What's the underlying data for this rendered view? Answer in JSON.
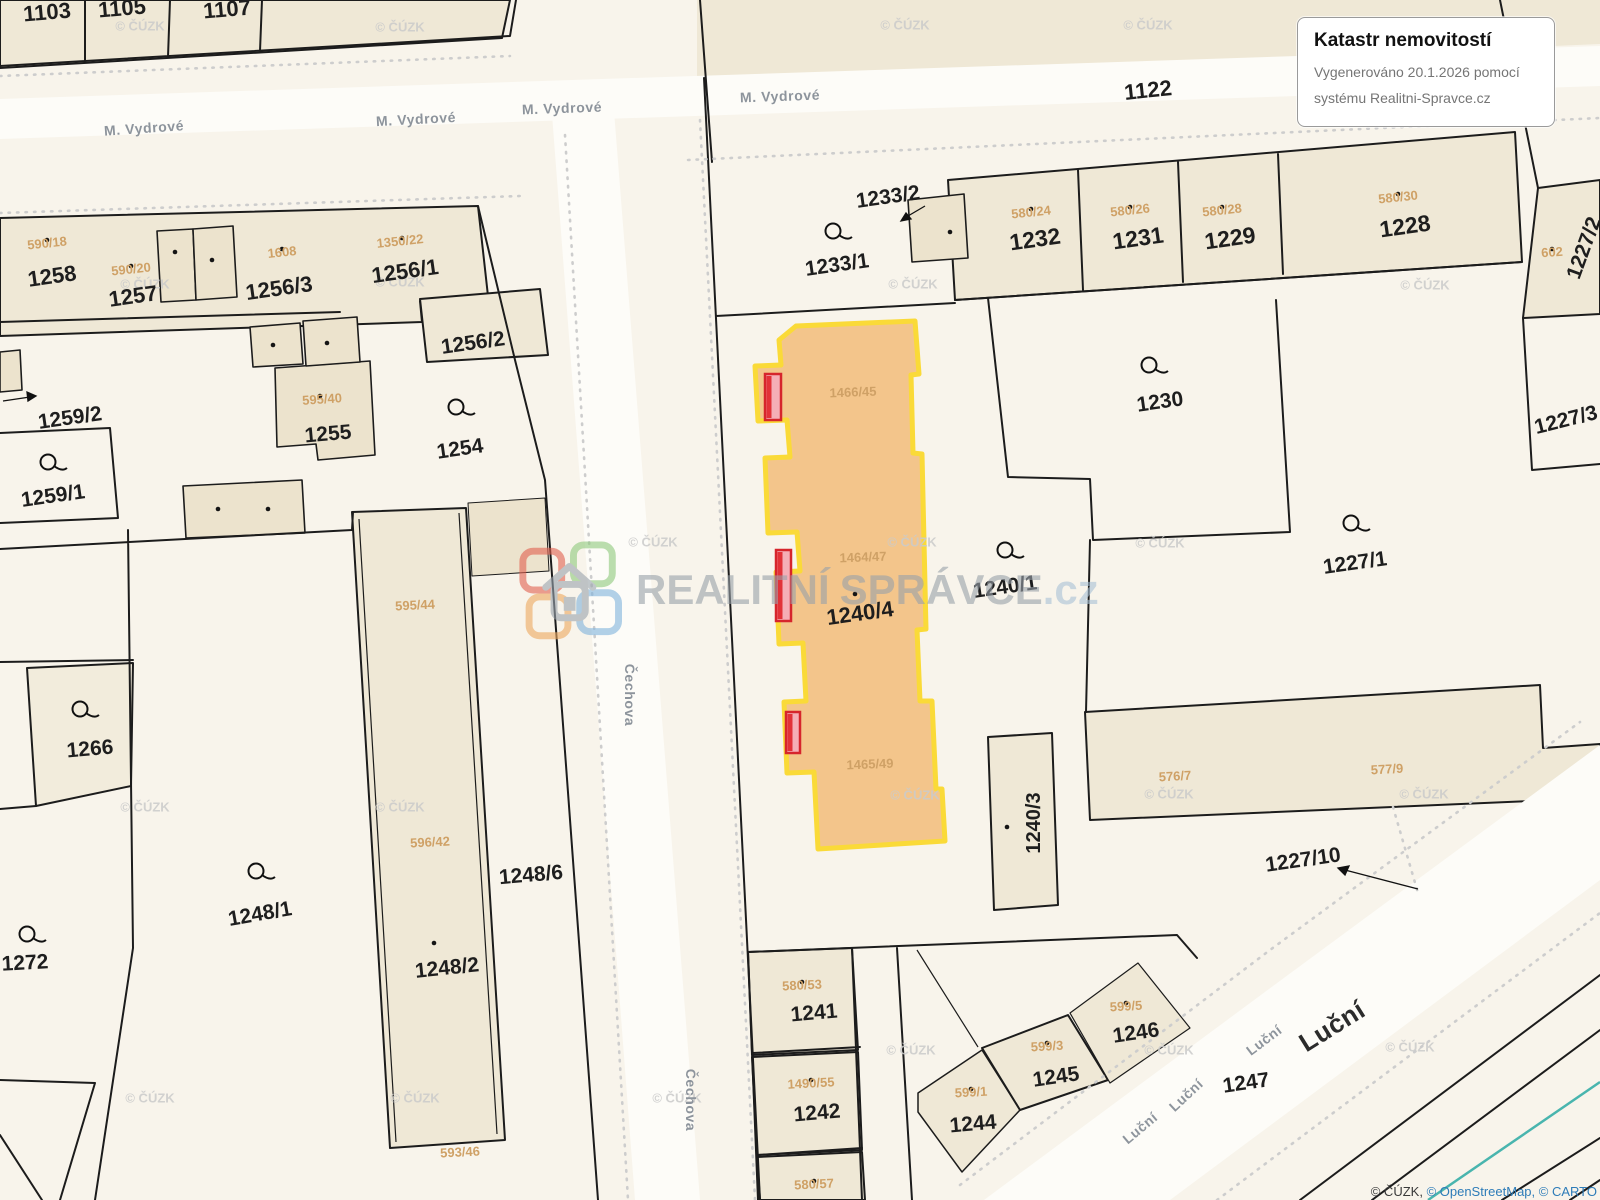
{
  "info_box": {
    "title": "Katastr nemovitostí",
    "line1": "Vygenerováno 20.1.2026 pomocí",
    "line2": "systému Realitni-Spravce.cz"
  },
  "watermark_brand": {
    "part1": "REALITNÍ",
    "part2": "SPRÁVCE",
    "part3": ".cz"
  },
  "attribution": {
    "cuzk": "© ČÚZK,",
    "osm": "© OpenStreetMap,",
    "carto": "© CARTO"
  },
  "map": {
    "highlighted_parcel": "1240/4",
    "colors": {
      "highlight_fill": "#f2c183",
      "highlight_border": "#fada38",
      "marker": "#d6252c"
    },
    "cuzk_watermark_text": "© ČÚZK",
    "parcel_labels": [
      {
        "t": "1103",
        "x": 47,
        "y": 12,
        "r": -5,
        "s": 22
      },
      {
        "t": "1105",
        "x": 122,
        "y": 8,
        "r": -5,
        "s": 22
      },
      {
        "t": "1107",
        "x": 227,
        "y": 9,
        "r": -5,
        "s": 22
      },
      {
        "t": "1122",
        "x": 1148,
        "y": 90,
        "r": -6,
        "s": 22
      },
      {
        "t": "1258",
        "x": 52,
        "y": 276,
        "r": -8,
        "s": 22
      },
      {
        "t": "1257",
        "x": 133,
        "y": 296,
        "r": -8,
        "s": 22
      },
      {
        "t": "1256/3",
        "x": 279,
        "y": 288,
        "r": -8,
        "s": 22
      },
      {
        "t": "1256/1",
        "x": 405,
        "y": 271,
        "r": -8,
        "s": 22
      },
      {
        "t": "1256/2",
        "x": 473,
        "y": 343,
        "r": -8,
        "s": 21
      },
      {
        "t": "1255",
        "x": 328,
        "y": 434,
        "r": -5,
        "s": 21
      },
      {
        "t": "1254",
        "x": 460,
        "y": 449,
        "r": -8,
        "s": 21
      },
      {
        "t": "1259/2",
        "x": 70,
        "y": 418,
        "r": -8,
        "s": 21
      },
      {
        "t": "1259/1",
        "x": 53,
        "y": 496,
        "r": -8,
        "s": 21
      },
      {
        "t": "1266",
        "x": 90,
        "y": 749,
        "r": -5,
        "s": 21
      },
      {
        "t": "1272",
        "x": 25,
        "y": 963,
        "r": -3,
        "s": 21
      },
      {
        "t": "1248/1",
        "x": 260,
        "y": 914,
        "r": -10,
        "s": 21
      },
      {
        "t": "1248/2",
        "x": 447,
        "y": 968,
        "r": -6,
        "s": 21
      },
      {
        "t": "1248/6",
        "x": 531,
        "y": 875,
        "r": -5,
        "s": 21
      },
      {
        "t": "1233/2",
        "x": 888,
        "y": 197,
        "r": -8,
        "s": 21
      },
      {
        "t": "1233/1",
        "x": 837,
        "y": 265,
        "r": -8,
        "s": 21
      },
      {
        "t": "1232",
        "x": 1035,
        "y": 239,
        "r": -8,
        "s": 23
      },
      {
        "t": "1231",
        "x": 1138,
        "y": 238,
        "r": -8,
        "s": 23
      },
      {
        "t": "1229",
        "x": 1230,
        "y": 238,
        "r": -8,
        "s": 23
      },
      {
        "t": "1228",
        "x": 1405,
        "y": 226,
        "r": -8,
        "s": 23
      },
      {
        "t": "1227/2",
        "x": 1584,
        "y": 248,
        "r": -70,
        "s": 21
      },
      {
        "t": "1230",
        "x": 1160,
        "y": 402,
        "r": -8,
        "s": 21
      },
      {
        "t": "1227/3",
        "x": 1566,
        "y": 420,
        "r": -14,
        "s": 21
      },
      {
        "t": "1227/1",
        "x": 1355,
        "y": 563,
        "r": -8,
        "s": 21
      },
      {
        "t": "1240/1",
        "x": 1005,
        "y": 587,
        "r": -8,
        "s": 21
      },
      {
        "t": "1240/4",
        "x": 860,
        "y": 613,
        "r": -8,
        "s": 22
      },
      {
        "t": "1240/3",
        "x": 1034,
        "y": 823,
        "r": -90,
        "s": 20
      },
      {
        "t": "1227/10",
        "x": 1303,
        "y": 860,
        "r": -8,
        "s": 21
      },
      {
        "t": "1241",
        "x": 814,
        "y": 1013,
        "r": -5,
        "s": 21
      },
      {
        "t": "1242",
        "x": 817,
        "y": 1113,
        "r": -5,
        "s": 21
      },
      {
        "t": "1244",
        "x": 973,
        "y": 1124,
        "r": -5,
        "s": 21
      },
      {
        "t": "1245",
        "x": 1056,
        "y": 1077,
        "r": -8,
        "s": 21
      },
      {
        "t": "1246",
        "x": 1136,
        "y": 1033,
        "r": -8,
        "s": 21
      },
      {
        "t": "1247",
        "x": 1246,
        "y": 1083,
        "r": -8,
        "s": 21
      }
    ],
    "small_labels": [
      {
        "t": "590/18",
        "x": 47,
        "y": 243,
        "r": -6
      },
      {
        "t": "590/20",
        "x": 131,
        "y": 269,
        "r": -6
      },
      {
        "t": "1608",
        "x": 282,
        "y": 252,
        "r": -6
      },
      {
        "t": "1350/22",
        "x": 400,
        "y": 241,
        "r": -6
      },
      {
        "t": "595/40",
        "x": 322,
        "y": 399,
        "r": -4
      },
      {
        "t": "595/44",
        "x": 415,
        "y": 605,
        "r": -3
      },
      {
        "t": "596/42",
        "x": 430,
        "y": 842,
        "r": -3
      },
      {
        "t": "593/46",
        "x": 460,
        "y": 1152,
        "r": -3
      },
      {
        "t": "1466/45",
        "x": 853,
        "y": 392,
        "r": -2
      },
      {
        "t": "1464/47",
        "x": 863,
        "y": 557,
        "r": -2
      },
      {
        "t": "1465/49",
        "x": 870,
        "y": 764,
        "r": -2
      },
      {
        "t": "580/24",
        "x": 1031,
        "y": 212,
        "r": -6
      },
      {
        "t": "580/26",
        "x": 1130,
        "y": 210,
        "r": -6
      },
      {
        "t": "580/28",
        "x": 1222,
        "y": 210,
        "r": -6
      },
      {
        "t": "580/30",
        "x": 1398,
        "y": 197,
        "r": -6
      },
      {
        "t": "602",
        "x": 1552,
        "y": 252,
        "r": -4
      },
      {
        "t": "576/7",
        "x": 1175,
        "y": 776,
        "r": -3
      },
      {
        "t": "577/9",
        "x": 1387,
        "y": 769,
        "r": -3
      },
      {
        "t": "580/53",
        "x": 802,
        "y": 985,
        "r": -3
      },
      {
        "t": "1490/55",
        "x": 811,
        "y": 1083,
        "r": -3
      },
      {
        "t": "580/57",
        "x": 814,
        "y": 1184,
        "r": -3
      },
      {
        "t": "599/1",
        "x": 971,
        "y": 1092,
        "r": -3
      },
      {
        "t": "599/3",
        "x": 1047,
        "y": 1046,
        "r": -3
      },
      {
        "t": "599/5",
        "x": 1126,
        "y": 1006,
        "r": -3
      }
    ],
    "street_labels": [
      {
        "t": "M. Vydrové",
        "x": 144,
        "y": 128,
        "r": -4
      },
      {
        "t": "M. Vydrové",
        "x": 416,
        "y": 119,
        "r": -3
      },
      {
        "t": "M. Vydrové",
        "x": 562,
        "y": 108,
        "r": -2
      },
      {
        "t": "M. Vydrové",
        "x": 780,
        "y": 96,
        "r": -2
      },
      {
        "t": "Čechova",
        "x": 630,
        "y": 695,
        "r": 90
      },
      {
        "t": "Čechova",
        "x": 691,
        "y": 1100,
        "r": 90
      },
      {
        "t": "Luční",
        "x": 1264,
        "y": 1040,
        "r": -37
      },
      {
        "t": "Luční",
        "x": 1186,
        "y": 1095,
        "r": -43
      },
      {
        "t": "Luční",
        "x": 1140,
        "y": 1128,
        "r": -40
      },
      {
        "t": "Luční",
        "x": 1332,
        "y": 1026,
        "r": -32,
        "big": true
      }
    ],
    "watermarks": [
      [
        140,
        26
      ],
      [
        400,
        27
      ],
      [
        905,
        25
      ],
      [
        1148,
        25
      ],
      [
        145,
        284
      ],
      [
        400,
        282
      ],
      [
        913,
        284
      ],
      [
        1425,
        285
      ],
      [
        653,
        542
      ],
      [
        912,
        542
      ],
      [
        1160,
        543
      ],
      [
        145,
        807
      ],
      [
        400,
        807
      ],
      [
        915,
        795
      ],
      [
        1169,
        794
      ],
      [
        1424,
        794
      ],
      [
        150,
        1098
      ],
      [
        415,
        1098
      ],
      [
        677,
        1098
      ],
      [
        911,
        1050
      ],
      [
        1169,
        1050
      ],
      [
        1410,
        1047
      ]
    ],
    "loop_symbols": [
      [
        833,
        231
      ],
      [
        1149,
        365
      ],
      [
        1351,
        523
      ],
      [
        456,
        407
      ],
      [
        48,
        462
      ],
      [
        80,
        709
      ],
      [
        256,
        871
      ],
      [
        27,
        934
      ],
      [
        1005,
        550
      ]
    ],
    "building_dots": [
      [
        175,
        252
      ],
      [
        212,
        260
      ],
      [
        273,
        345
      ],
      [
        327,
        343
      ],
      [
        218,
        509
      ],
      [
        268,
        509
      ],
      [
        950,
        232
      ],
      [
        855,
        594
      ],
      [
        1007,
        827
      ],
      [
        434,
        943
      ],
      [
        47,
        240
      ],
      [
        131,
        266
      ],
      [
        282,
        249
      ],
      [
        402,
        238
      ],
      [
        320,
        396
      ],
      [
        1031,
        209
      ],
      [
        1130,
        207
      ],
      [
        1222,
        207
      ],
      [
        1398,
        194
      ],
      [
        1552,
        249
      ],
      [
        802,
        982
      ],
      [
        811,
        1080
      ],
      [
        814,
        1181
      ],
      [
        971,
        1089
      ],
      [
        1047,
        1043
      ],
      [
        1126,
        1003
      ]
    ]
  }
}
